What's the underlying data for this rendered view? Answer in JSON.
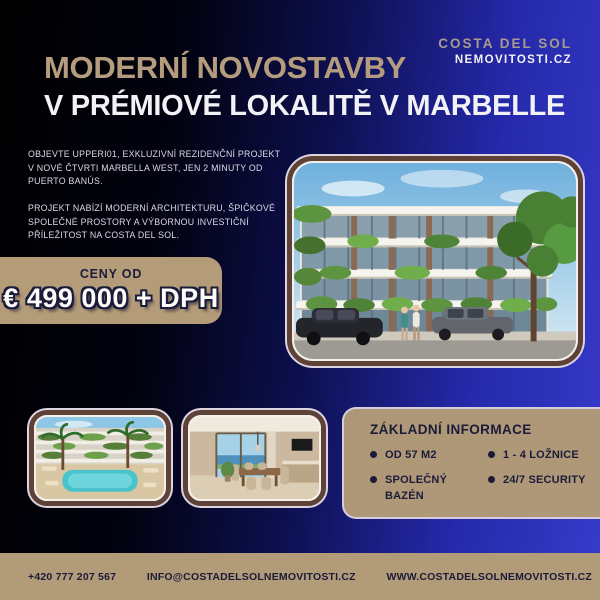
{
  "header": {
    "title_line1": "MODERNÍ NOVOSTAVBY",
    "title_line2": "V PRÉMIOVÉ LOKALITĚ V MARBELLE"
  },
  "logo": {
    "line1": "COSTA DEL SOL",
    "line2": "NEMOVITOSTI.CZ"
  },
  "intro": {
    "paragraph1": "OBJEVTE UPPERI01, EXKLUZIVNÍ REZIDENČNÍ PROJEKT V NOVÉ ČTVRTI MARBELLA WEST, JEN 2 MINUTY OD PUERTO BANÚS.",
    "paragraph2": "PROJEKT NABÍZÍ MODERNÍ ARCHITEKTURU, ŠPIČKOVÉ SPOLEČNÉ PROSTORY A VÝBORNOU INVESTIČNÍ PŘÍLEŽITOST NA COSTA DEL SOL."
  },
  "price": {
    "label": "CENY OD",
    "value": "€ 499 000 + DPH"
  },
  "images": {
    "main": "apartment-building-render",
    "thumb1": "pool-courtyard-render",
    "thumb2": "dining-interior-render"
  },
  "info_box": {
    "title": "ZÁKLADNÍ INFORMACE",
    "items": [
      "OD 57 M2",
      "1 - 4 LOŽNICE",
      "SPOLEČNÝ BAZÉN",
      "24/7 SECURITY"
    ]
  },
  "footer": {
    "phone": "+420 777 207 567",
    "email": "INFO@COSTADELSOLNEMOVITOSTI.CZ",
    "website": "WWW.COSTADELSOLNEMOVITOSTI.CZ"
  },
  "colors": {
    "background_blue": "#373bca",
    "beige": "#b19b79",
    "navy_text": "#1b1b3a",
    "gold_title": "#b59c7e"
  }
}
